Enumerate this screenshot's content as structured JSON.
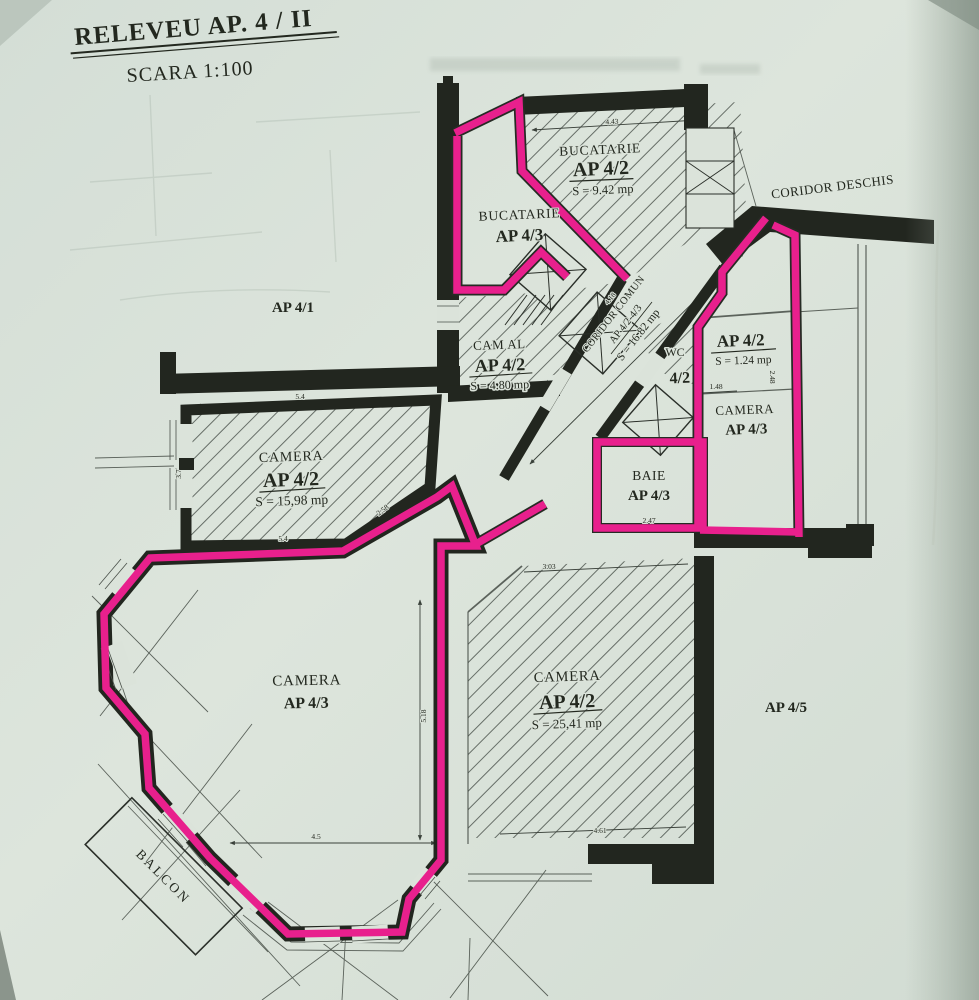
{
  "title": {
    "main": "RELEVEU AP. 4 / II",
    "scale": "SCARA 1:100"
  },
  "neighbors": {
    "left": "AP 4/1",
    "right": "AP 4/5",
    "coridor": "CORIDOR DESCHIS",
    "balcon": "BALCON"
  },
  "rooms": {
    "bucatarie_42": {
      "name": "BUCATARIE",
      "ap": "AP 4/2",
      "area": "S = 9.42 mp"
    },
    "bucatarie_43": {
      "name": "BUCATARIE",
      "ap": "AP 4/3"
    },
    "cam_al_42": {
      "name": "CAM AL",
      "ap": "AP 4/2",
      "area": "S = 4.80 mp"
    },
    "coridor_comun": {
      "name": "CORIDOR COMUN",
      "ap": "AP 4/2-4/3",
      "area": "S = 16.82 mp"
    },
    "wc_42": {
      "name": "WC",
      "ap": "4/2"
    },
    "debara_42": {
      "ap": "AP 4/2",
      "area": "S = 1.24 mp"
    },
    "camera_43_dr": {
      "name": "CAMERA",
      "ap": "AP 4/3"
    },
    "baie_43": {
      "name": "BAIE",
      "ap": "AP 4/3"
    },
    "camera_42_15": {
      "name": "CAMERA",
      "ap": "AP 4/2",
      "area": "S = 15,98 mp"
    },
    "camera_43_mare": {
      "name": "CAMERA",
      "ap": "AP 4/3"
    },
    "camera_42_25": {
      "name": "CAMERA",
      "ap": "AP 4/2",
      "area": "S = 25,41 mp"
    }
  },
  "dimensions": {
    "baie": "2.47",
    "debara_w": "1.48",
    "debara_h": "2.48",
    "cam25_top": "3.03",
    "cam25_bottom": "4.61",
    "big_h": "5.18",
    "big_w": "4.5",
    "cam15_top": "5.4",
    "cam15_bottom": "5.4",
    "cam15_left": "3.7",
    "cam15_diag": "2.58",
    "kitchen_top": "4.43",
    "coridor": "4.18"
  },
  "colors": {
    "highlight": "#e8208d",
    "paper": "#dbe3da",
    "wall": "#22261f"
  }
}
